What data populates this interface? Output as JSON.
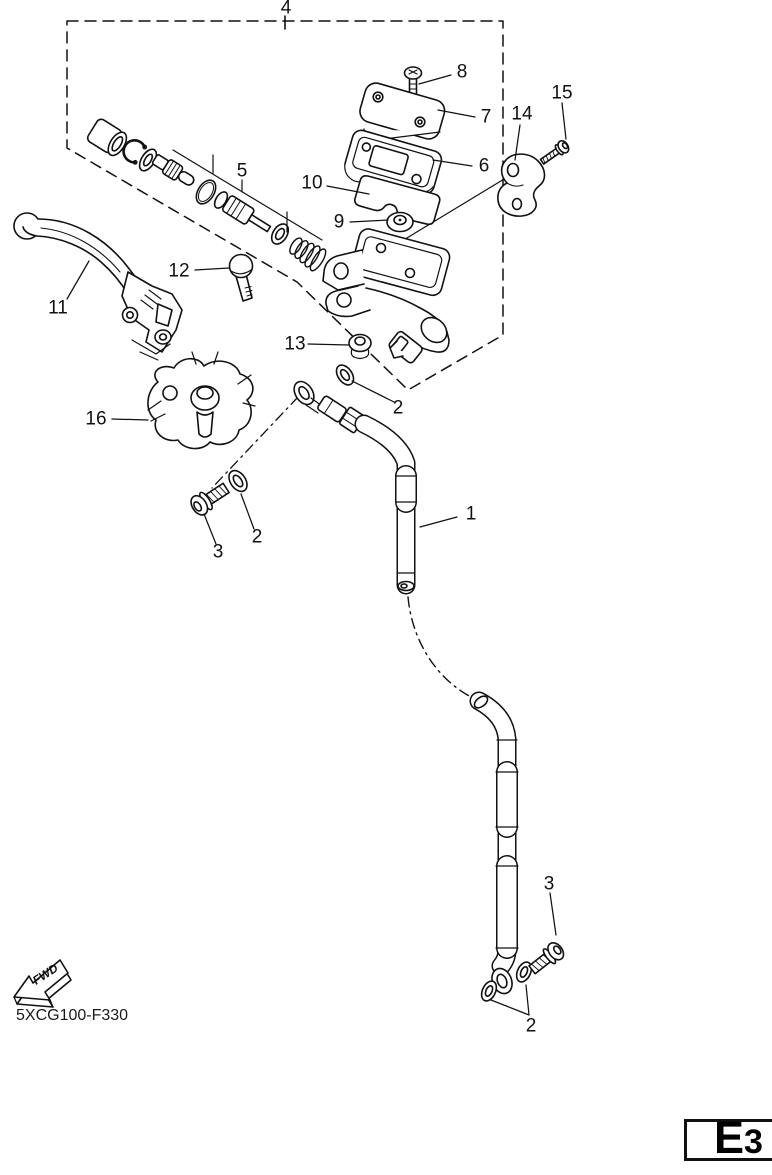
{
  "diagram": {
    "code": "5XCG100-F330",
    "fwd_label": "FWD",
    "page_ref": "E3",
    "callouts": [
      {
        "label": "4",
        "x": 286,
        "y": 8
      },
      {
        "label": "8",
        "x": 462,
        "y": 72
      },
      {
        "label": "7",
        "x": 486,
        "y": 117
      },
      {
        "label": "15",
        "x": 562,
        "y": 93
      },
      {
        "label": "14",
        "x": 522,
        "y": 114
      },
      {
        "label": "5",
        "x": 242,
        "y": 171
      },
      {
        "label": "10",
        "x": 312,
        "y": 183
      },
      {
        "label": "6",
        "x": 484,
        "y": 166
      },
      {
        "label": "9",
        "x": 339,
        "y": 222
      },
      {
        "label": "12",
        "x": 179,
        "y": 271
      },
      {
        "label": "11",
        "x": 58,
        "y": 308
      },
      {
        "label": "13",
        "x": 295,
        "y": 344
      },
      {
        "label": "2",
        "x": 398,
        "y": 408
      },
      {
        "label": "16",
        "x": 96,
        "y": 419
      },
      {
        "label": "1",
        "x": 471,
        "y": 514
      },
      {
        "label": "2",
        "x": 257,
        "y": 537
      },
      {
        "label": "3",
        "x": 218,
        "y": 552
      },
      {
        "label": "3",
        "x": 549,
        "y": 884
      },
      {
        "label": "2",
        "x": 531,
        "y": 1026
      }
    ]
  }
}
